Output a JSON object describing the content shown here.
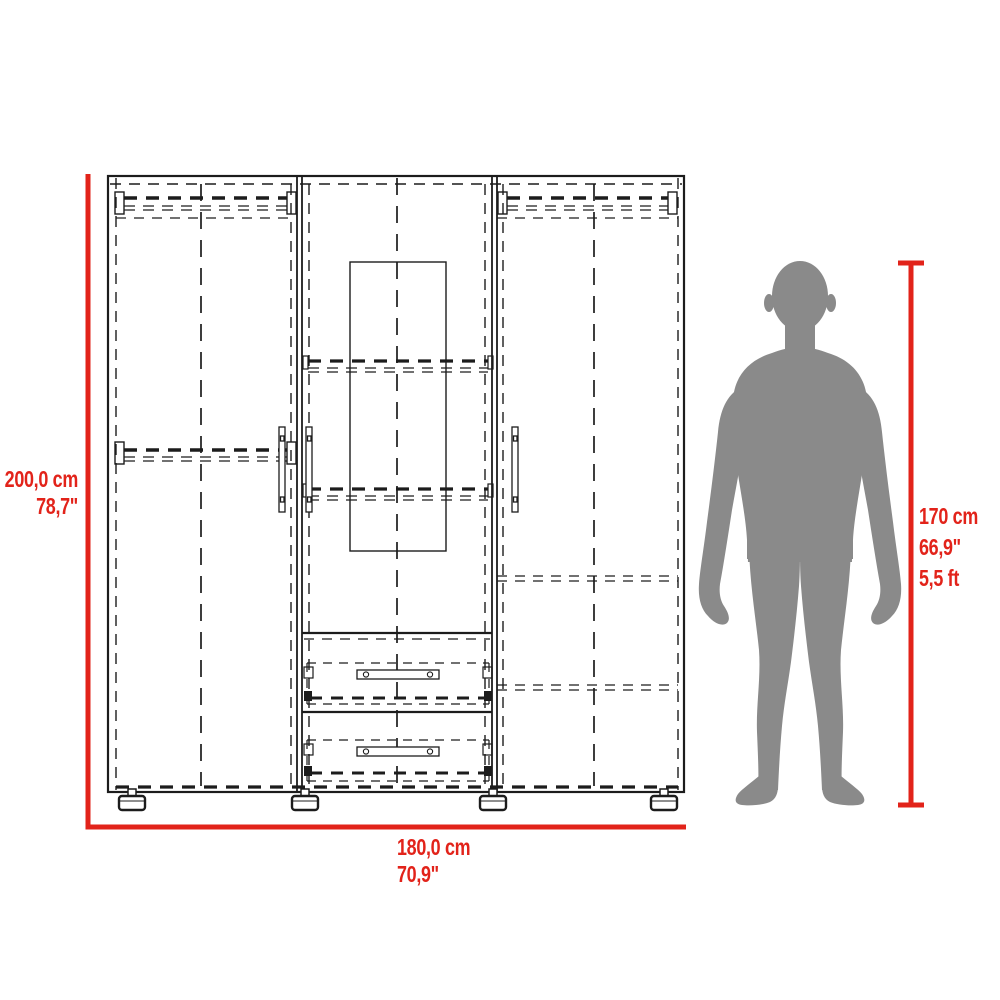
{
  "page": {
    "title": "Wardrobe dimensional drawing with human scale figure"
  },
  "dimensions": {
    "height": {
      "metric": "200,0 cm",
      "imperial": "78,7\""
    },
    "width": {
      "metric": "180,0 cm",
      "imperial": "70,9\""
    },
    "human": {
      "metric": "170 cm",
      "imperial": "66,9\"",
      "feet": "5,5 ft"
    }
  },
  "colors": {
    "dimension_red": "#e2231a",
    "silhouette_gray": "#8a8a8a",
    "drawing_black": "#1c1c1c"
  },
  "figure": {
    "furniture": "wardrobe-front-elevation",
    "person": "standing-man-silhouette"
  }
}
